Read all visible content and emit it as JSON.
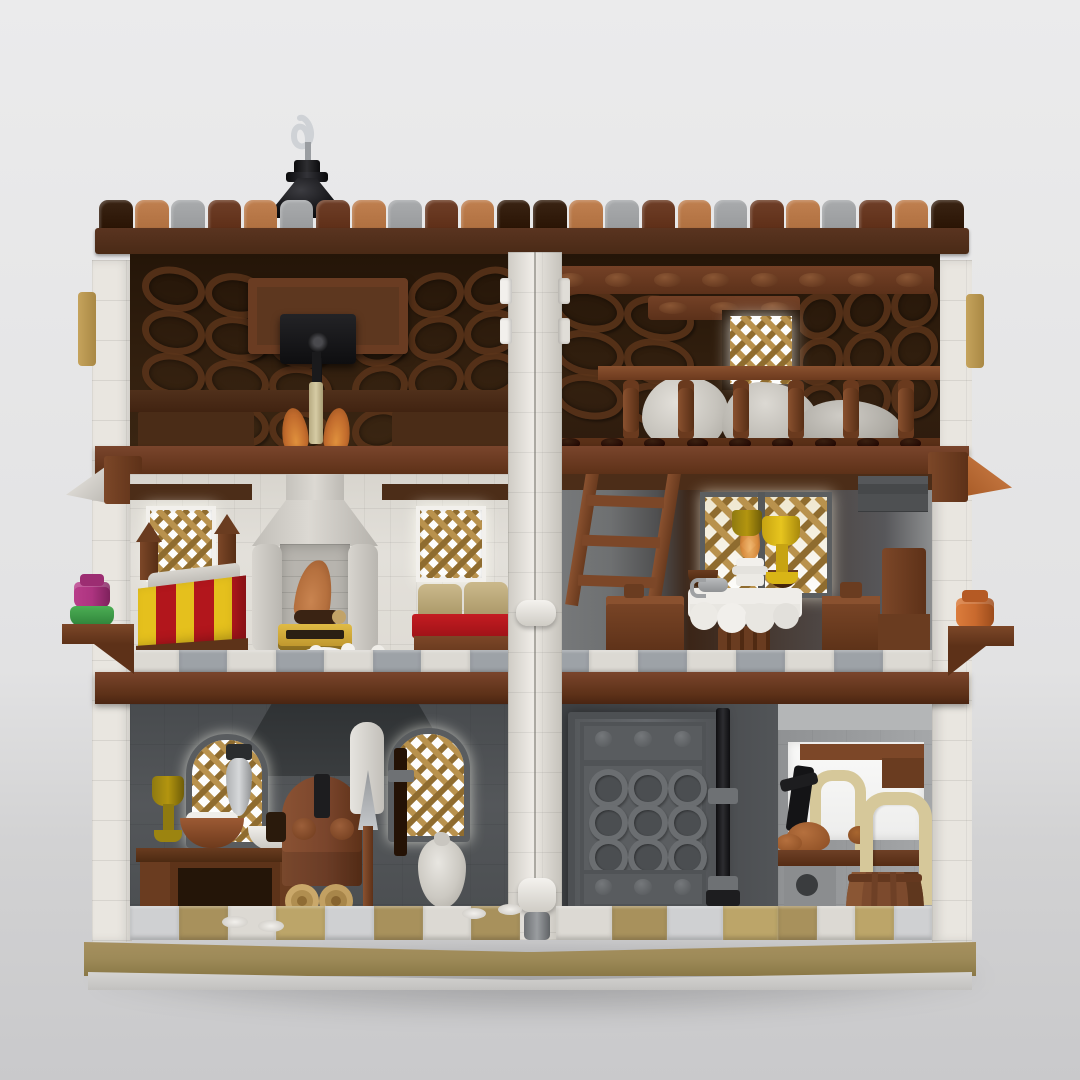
{
  "scene": {
    "kind": "3d-render",
    "subject": "LEGO medieval half-timbered tavern building, rear opened view exposing interior rooms on three levels",
    "background_style": "neutral studio grey with soft floor shadow"
  },
  "palette": {
    "bg_top": "#ebebec",
    "bg_mid": "#e2e2e3",
    "bg_floor": "#d2d2d3",
    "bg_floor2": "#c9c9cb",
    "white_wall": "#e9e6e0",
    "white_wall_dk": "#d6d2cb",
    "white_hi": "#f4f2ee",
    "plaster": "#e0ddd6",
    "roof_int": "#33200f",
    "roof_int_dk": "#241508",
    "dark_brown": "#3a2414",
    "beam_brown": "#4e2e1a",
    "red_brown": "#6f3f28",
    "red_brown_dk": "#57301a",
    "red_brown_lt": "#86512f",
    "nougat": "#c08050",
    "nougat_dk": "#a8662f",
    "tile_grey": "#a9abad",
    "tile_grey_dk": "#8f9193",
    "lattice_gold": "#b9924d",
    "lattice_gold_dk": "#8f6c2f",
    "window_glow": "#fdfdfc",
    "dark_wall": "#54575a",
    "darker_wall": "#3e4144",
    "hood_grey": "#35383a",
    "door_grey": "#5e6164",
    "door_grey_dk": "#4b4e51",
    "door_ring": "#6b6e71",
    "mid_grey": "#96989a",
    "grey_piece": "#b4b6b7",
    "light_grey": "#c9cbcc",
    "floor_white": "#dcd9d3",
    "floor_grey": "#9da2a7",
    "floor_tan": "#a8915c",
    "floor_tan_lt": "#bca569",
    "floor_light": "#cfd0d2",
    "base_tan": "#9d8a58",
    "base_tan_dk": "#8a7847",
    "red": "#b2161c",
    "yellow": "#e5c01d",
    "olive": "#b3950f",
    "magenta": "#ad3480",
    "green": "#3f9e47",
    "orange": "#c96a2e",
    "candle_tan": "#d2c79e",
    "cream": "#d6c89a",
    "flame": "#c96f2e",
    "flame_lt": "#e8963f",
    "copper_fire": "#b5703e",
    "black": "#1d1d1f",
    "silver": "#cfd2d6",
    "barrel": "#7c4a2d",
    "barrel_dk": "#5f371e",
    "fire_grey": "#c7c4be",
    "firebox": "#b7b4ae"
  },
  "roof": {
    "tile_colors": [
      "dark_brown",
      "nougat",
      "tile_grey",
      "red_brown",
      "nougat",
      "tile_grey",
      "red_brown",
      "nougat",
      "tile_grey",
      "red_brown",
      "nougat",
      "dark_brown",
      "dark_brown",
      "nougat",
      "tile_grey",
      "red_brown",
      "nougat",
      "tile_grey",
      "red_brown",
      "nougat",
      "tile_grey",
      "red_brown",
      "nougat",
      "dark_brown"
    ]
  },
  "attic_right": {
    "beam_stud_count": 8,
    "sub_beam_stud_count": 3,
    "baluster_count": 6,
    "floor_stud_count": 9
  },
  "door": {
    "ring_rows": 3,
    "ring_cols": 3,
    "band_stud_count": 3
  },
  "floors": {
    "mid_left": [
      "floor_white",
      "floor_grey",
      "floor_white",
      "floor_grey",
      "floor_white",
      "floor_grey",
      "floor_white",
      "floor_grey"
    ],
    "mid_right": [
      "floor_grey",
      "floor_white",
      "floor_grey",
      "floor_white",
      "floor_grey",
      "floor_white",
      "floor_grey",
      "floor_white"
    ],
    "ground_left": [
      "floor_light",
      "floor_tan",
      "floor_white",
      "floor_tan_lt",
      "floor_light",
      "floor_tan",
      "floor_white",
      "floor_tan"
    ],
    "ground_door": [
      "floor_white",
      "floor_tan",
      "floor_light",
      "floor_tan_lt"
    ],
    "ground_right": [
      "floor_tan",
      "floor_white",
      "floor_tan_lt",
      "floor_light"
    ]
  },
  "parts_visible": [
    "chimney-spire-with-hook",
    "crest-tile-row",
    "attic-rafter-panels",
    "ceiling-hoist",
    "candle-chandelier",
    "dormer-lattice-window",
    "grain-sacks",
    "railing-balusters",
    "stone-fireplace",
    "striped-bed",
    "cushion-bench",
    "lattice-windows",
    "wooden-ladder",
    "tavern-round-table",
    "goblets-and-bowls",
    "candlestick",
    "bread-oven",
    "bakery-counter",
    "chalice",
    "dough-bowl",
    "hanging-lantern",
    "bread-paddle",
    "fire-poker",
    "flour-sack",
    "log-pile",
    "reinforced-stud-door",
    "door-locking-bar",
    "storage-barrel",
    "tub-handle",
    "water-pump",
    "roast-chickens",
    "flower-pot-magenta",
    "flower-pot-green",
    "flower-pot-orange",
    "window-sill-brackets",
    "hinge-columns",
    "sand-baseplate"
  ]
}
